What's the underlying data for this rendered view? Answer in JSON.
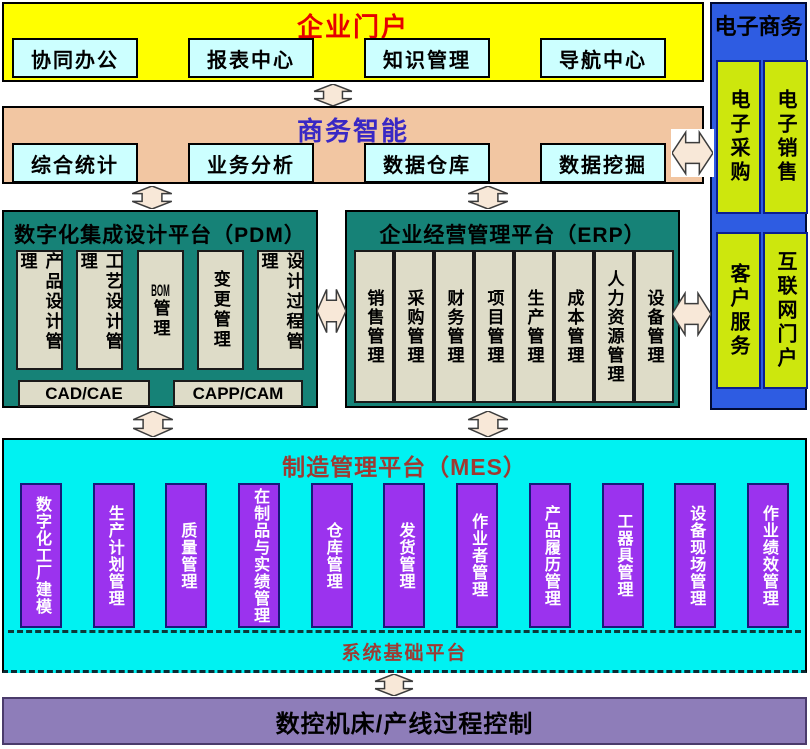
{
  "portal": {
    "title": "企业门户",
    "items": [
      "协同办公",
      "报表中心",
      "知识管理",
      "导航中心"
    ]
  },
  "bi": {
    "title": "商务智能",
    "items": [
      "综合统计",
      "业务分析",
      "数据仓库",
      "数据挖掘"
    ]
  },
  "pdm": {
    "title": "数字化集成设计平台（PDM）",
    "modules": [
      "产品设计管理",
      "工艺设计管理",
      "BOM管理",
      "变更管理",
      "设计过程管理"
    ],
    "tools": [
      "CAD/CAE",
      "CAPP/CAM"
    ]
  },
  "erp": {
    "title": "企业经营管理平台（ERP）",
    "modules": [
      "销售管理",
      "采购管理",
      "财务管理",
      "项目管理",
      "生产管理",
      "成本管理",
      "人力资源管理",
      "设备管理"
    ]
  },
  "ecommerce": {
    "title": "电子商务",
    "modules": [
      "电子采购",
      "电子销售",
      "客户服务",
      "互联网门户"
    ]
  },
  "mes": {
    "title": "制造管理平台（MES）",
    "modules": [
      "数字化工厂建模",
      "生产计划管理",
      "质量管理",
      "在制品与实绩管理",
      "仓库管理",
      "发货管理",
      "作业者管理",
      "产品履历管理",
      "工器具管理",
      "设备现场管理",
      "作业绩效管理"
    ],
    "base_label": "系统基础平台"
  },
  "control": {
    "title": "数控机床/产线过程控制"
  },
  "colors": {
    "portal_bg": "#FFFF00",
    "portal_title": "#E60000",
    "bi_bg": "#F2C6A2",
    "bi_title": "#3928C4",
    "platform_bg": "#168277",
    "platform_module_bg": "#DEDCC8",
    "ecommerce_bg": "#2E5CE2",
    "ecommerce_module_bg": "#CDE70D",
    "mes_bg": "#00F2F2",
    "mes_module_bg": "#9B33EE",
    "mes_title": "#9E3A32",
    "control_bg": "#8E7DB9",
    "sub_box_bg": "#CCFFFF",
    "arrow_fill": "#F8E8D8"
  }
}
